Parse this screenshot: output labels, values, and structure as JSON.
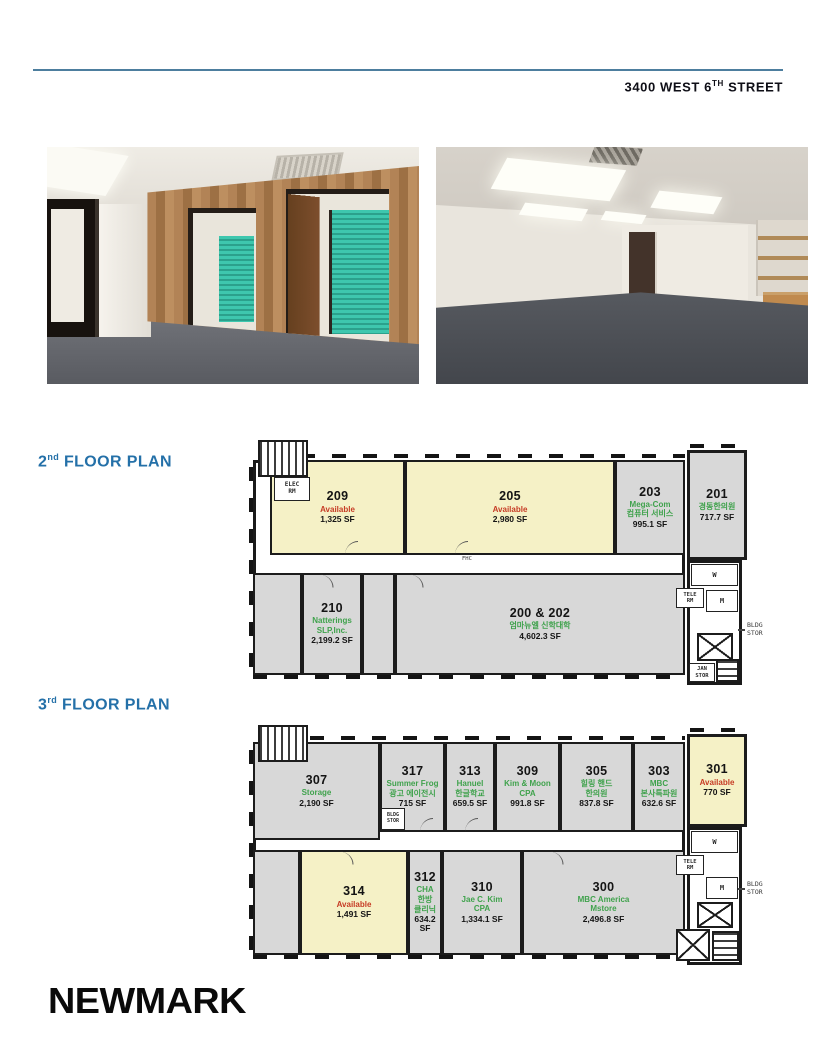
{
  "header": {
    "address_main": "3400 WEST 6",
    "address_sup": "TH",
    "address_tail": " STREET"
  },
  "floor_plans": [
    {
      "title_num": "2",
      "title_sup": "nd",
      "title_rest": " FLOOR PLAN",
      "rooms": [
        {
          "number": "209",
          "tenant": "Available",
          "sf": "1,325 SF",
          "status": "available"
        },
        {
          "number": "205",
          "tenant": "Available",
          "sf": "2,980 SF",
          "status": "available"
        },
        {
          "number": "203",
          "tenant": "Mega-Com\n컴퓨터 서비스",
          "sf": "995.1 SF",
          "status": "leased"
        },
        {
          "number": "201",
          "tenant": "경동한의원",
          "sf": "717.7 SF",
          "status": "leased"
        },
        {
          "number": "210",
          "tenant": "Natterings\nSLP,Inc.",
          "sf": "2,199.2 SF",
          "status": "leased"
        },
        {
          "number": "200 & 202",
          "tenant": "엄마뉴엘 신학대학",
          "sf": "4,602.3 SF",
          "status": "leased"
        }
      ],
      "labels": {
        "elec": "ELEC\nRM",
        "fhc": "FHC",
        "w": "W",
        "m": "M",
        "tele": "TELE\nRM",
        "jan": "JAN\nSTOR",
        "bldg": "BLDG\nSTOR"
      }
    },
    {
      "title_num": "3",
      "title_sup": "rd",
      "title_rest": " FLOOR PLAN",
      "rooms": [
        {
          "number": "307",
          "tenant": "Storage",
          "sf": "2,190 SF",
          "status": "leased"
        },
        {
          "number": "317",
          "tenant": "Summer Frog\n광고 에이전시",
          "sf": "715 SF",
          "status": "leased"
        },
        {
          "number": "313",
          "tenant": "Hanuel\n한글학교",
          "sf": "659.5 SF",
          "status": "leased"
        },
        {
          "number": "309",
          "tenant": "Kim & Moon\nCPA",
          "sf": "991.8 SF",
          "status": "leased"
        },
        {
          "number": "305",
          "tenant": "힐링 핸드\n한의원",
          "sf": "837.8 SF",
          "status": "leased"
        },
        {
          "number": "303",
          "tenant": "MBC\n본사특파원",
          "sf": "632.6 SF",
          "status": "leased"
        },
        {
          "number": "301",
          "tenant": "Available",
          "sf": "770 SF",
          "status": "available"
        },
        {
          "number": "314",
          "tenant": "Available",
          "sf": "1,491 SF",
          "status": "available"
        },
        {
          "number": "312",
          "tenant": "CHA\n한방\n클리닉",
          "sf": "634.2 SF",
          "status": "leased"
        },
        {
          "number": "310",
          "tenant": "Jae C. Kim\nCPA",
          "sf": "1,334.1 SF",
          "status": "leased"
        },
        {
          "number": "300",
          "tenant": "MBC America\nMstore",
          "sf": "2,496.8 SF",
          "status": "leased"
        }
      ],
      "labels": {
        "w": "W",
        "m": "M",
        "tele": "TELE\nRM",
        "bldg_small": "BLDG\nSTOR",
        "bldg": "BLDG\nSTOR"
      }
    }
  ],
  "footer": {
    "logo": "NEWMARK"
  },
  "colors": {
    "accent_blue": "#2470a8",
    "rule_blue": "#4d7e9e",
    "available_red": "#c63b24",
    "tenant_green": "#3fa24c",
    "room_yellow": "#f5f1c6",
    "room_gray": "#d8d8d8",
    "wall_dark": "#1a1a1a"
  }
}
